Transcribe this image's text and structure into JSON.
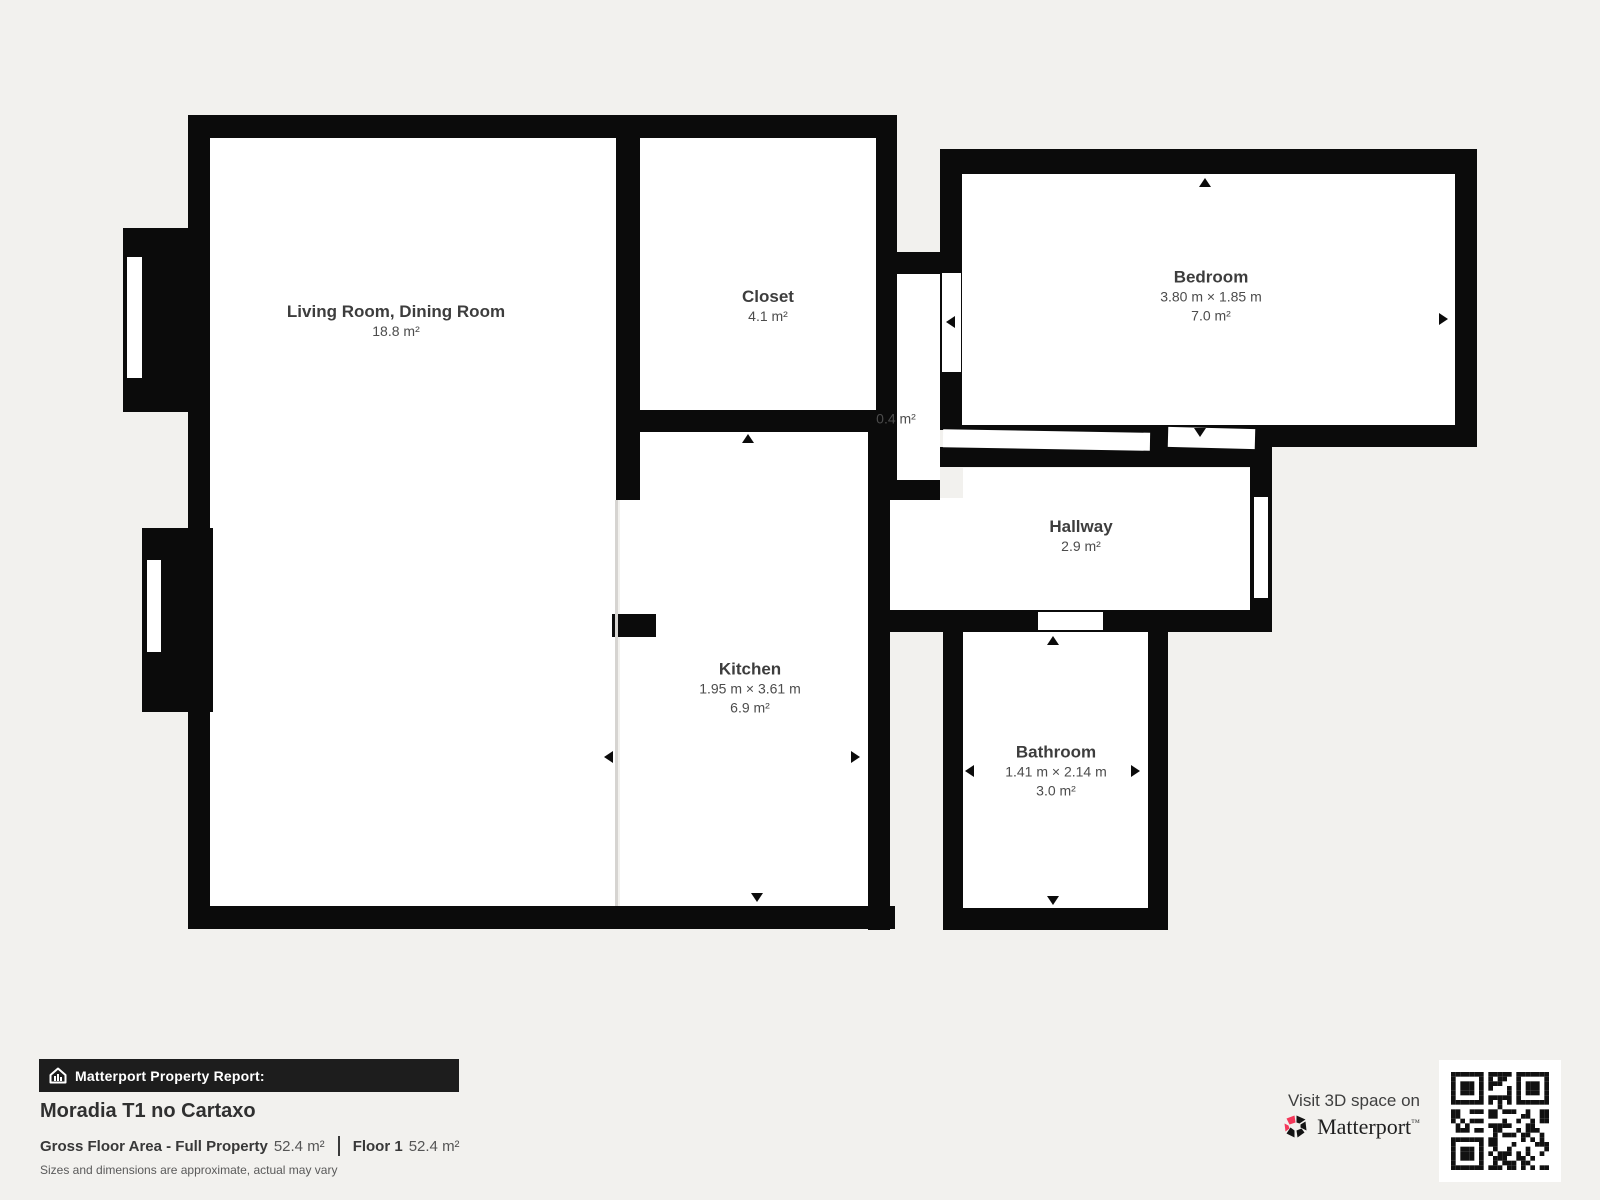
{
  "rooms": [
    {
      "id": "living",
      "name": "Living Room, Dining Room",
      "dims": "",
      "area": "18.8 m²"
    },
    {
      "id": "closet",
      "name": "Closet",
      "dims": "",
      "area": "4.1 m²"
    },
    {
      "id": "bedroom",
      "name": "Bedroom",
      "dims": "3.80 m × 1.85 m",
      "area": "7.0 m²"
    },
    {
      "id": "vestibule",
      "name": "",
      "dims": "",
      "area": "0.4 m²"
    },
    {
      "id": "hallway",
      "name": "Hallway",
      "dims": "",
      "area": "2.9 m²"
    },
    {
      "id": "kitchen",
      "name": "Kitchen",
      "dims": "1.95 m × 3.61 m",
      "area": "6.9 m²"
    },
    {
      "id": "bathroom",
      "name": "Bathroom",
      "dims": "1.41 m × 2.14 m",
      "area": "3.0 m²"
    }
  ],
  "report": {
    "banner": "Matterport Property Report:",
    "property_name": "Moradia T1 no Cartaxo",
    "gross_label": "Gross Floor Area - Full Property",
    "gross_value": "52.4 m²",
    "floor_label": "Floor 1",
    "floor_value": "52.4 m²",
    "disclaimer": "Sizes and dimensions are approximate, actual may vary"
  },
  "cta": {
    "visit_text": "Visit 3D space on",
    "brand": "Matterport",
    "brand_mark": "™"
  },
  "colors": {
    "wall": "#0b0b0b",
    "room": "#ffffff",
    "background": "#f2f1ee",
    "brand_red": "#f4385a"
  }
}
